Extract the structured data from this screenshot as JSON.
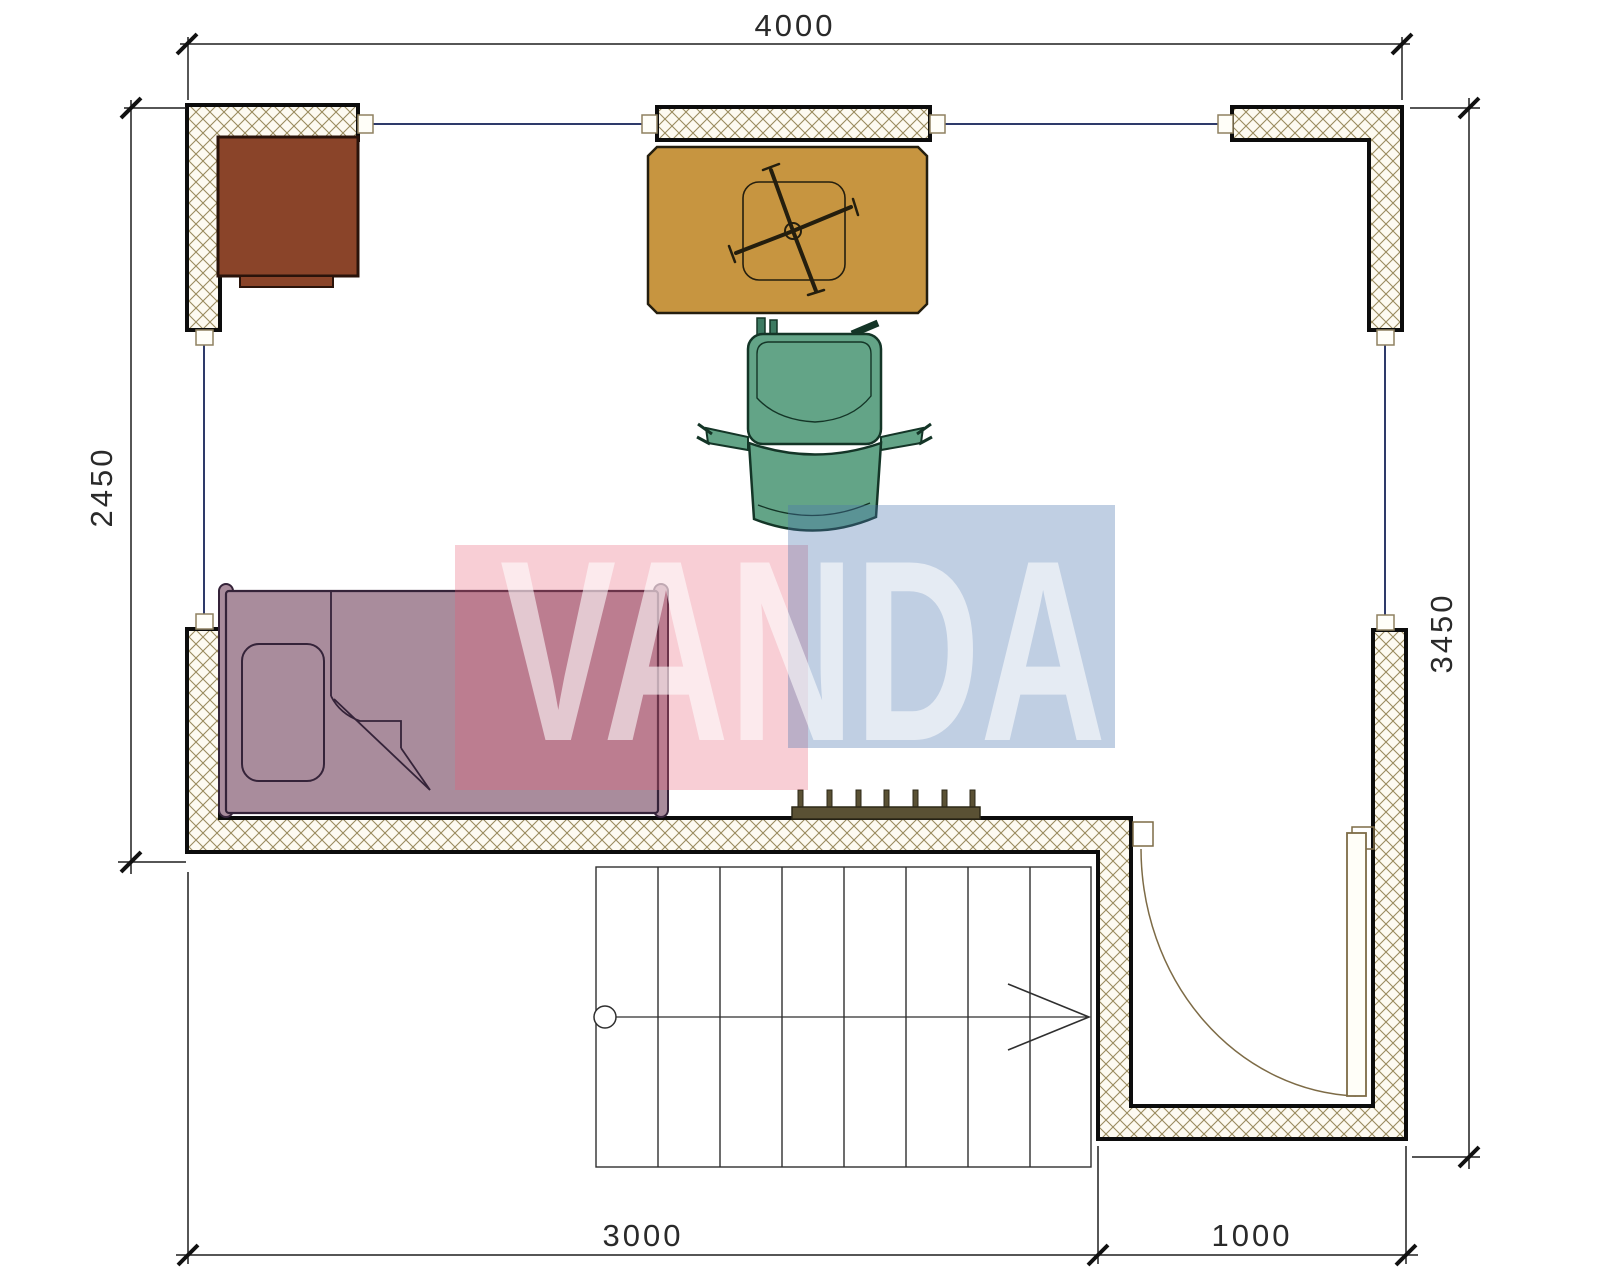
{
  "dimensions": {
    "top": "4000",
    "left": "2450",
    "right": "3450",
    "bottom_left": "3000",
    "bottom_right": "1000"
  },
  "watermark": {
    "text": "VANDA",
    "pink_color": "#e85d74",
    "blue_color": "#4b76b0",
    "letter_color": "#ffffff"
  },
  "colors": {
    "wall_border": "#0c0c0c",
    "hatch_line": "#9a8b5e",
    "hatch_bg": "#fdfaf1",
    "window_line": "#2e3a6a",
    "dimension_line": "#1f1f1f",
    "desk": "#8a4429",
    "table": "#c79540",
    "chair": "#63a487",
    "bed": "#a98c9c",
    "radiator": "#5a5134",
    "door_line": "#7d6b46",
    "stairs_line": "#2f2f2f"
  },
  "furniture_icons": {
    "desk": "corner-desk",
    "table": "work-table-with-task-chair-base",
    "chair": "office-armchair",
    "bed": "single-bed",
    "radiator": "radiator",
    "stairs": "staircase-up-arrow",
    "door": "swing-door"
  }
}
